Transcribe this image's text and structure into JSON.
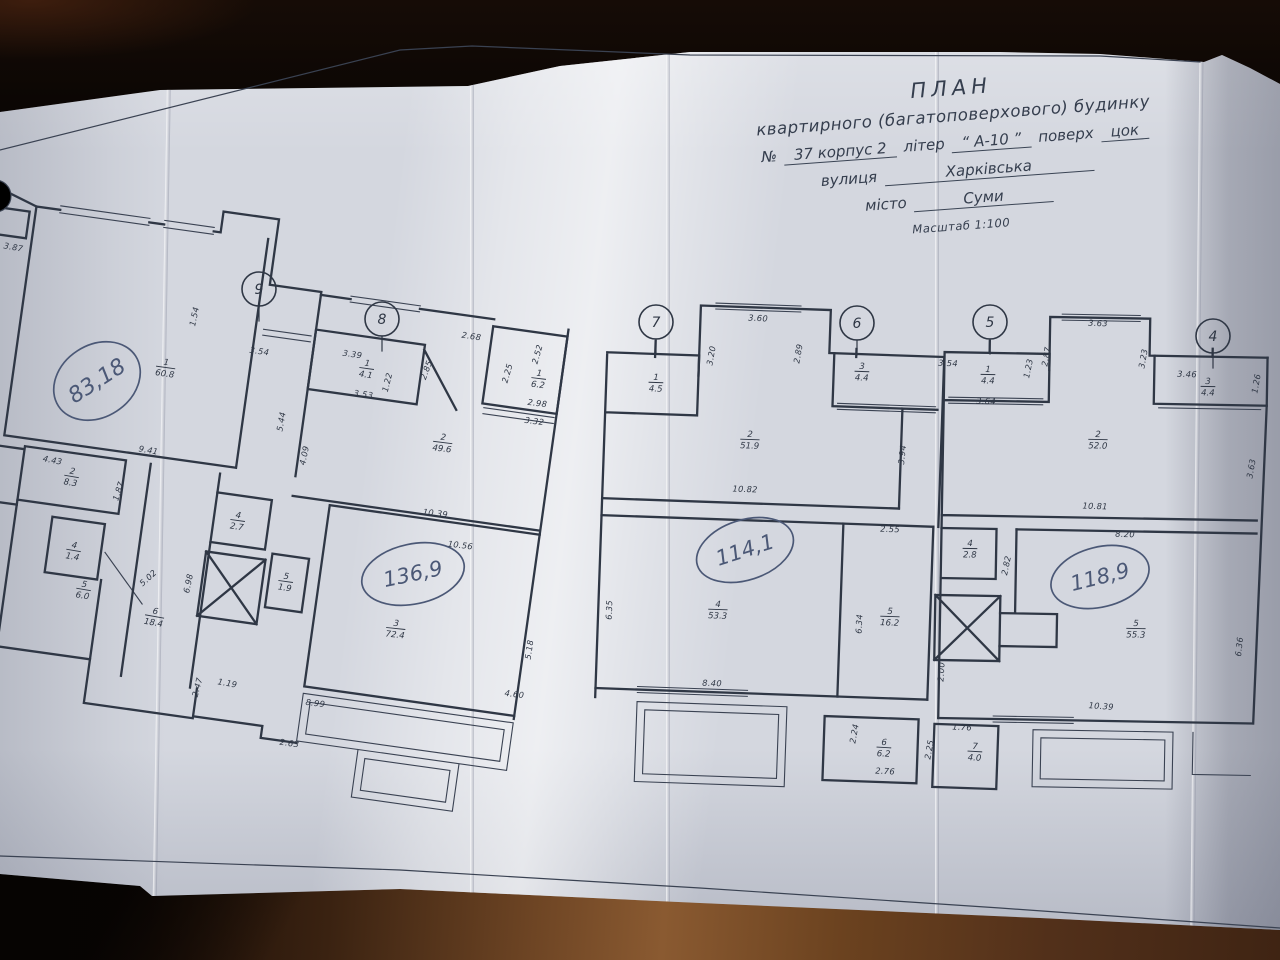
{
  "title_block": {
    "line1": "ПЛАН",
    "line2": "квартирного (багатоповерхового) будинку",
    "no_label": "№",
    "no_value": "37 корпус 2",
    "liter_label": "літер",
    "liter_value": "“ А-10 ”",
    "floor_label": "поверх",
    "floor_value": "цок",
    "street_label": "вулиця",
    "street_value": "Харківська",
    "city_label": "місто",
    "city_value": "Суми",
    "scale": "Масштаб 1:100"
  },
  "plan": {
    "ink": "#2f3745",
    "pen": "#4b5876",
    "axes": [
      {
        "label": "9",
        "x": 259,
        "y": 289
      },
      {
        "label": "8",
        "x": 382,
        "y": 319
      },
      {
        "label": "7",
        "x": 656,
        "y": 322
      },
      {
        "label": "6",
        "x": 857,
        "y": 323
      },
      {
        "label": "5",
        "x": 990,
        "y": 322
      },
      {
        "label": "4",
        "x": 1213,
        "y": 336
      }
    ],
    "handwritten": [
      {
        "text": "83,18",
        "x": 97,
        "y": 381,
        "rot": -33,
        "rx": 46,
        "ry": 36,
        "fs": 22
      },
      {
        "text": "136,9",
        "x": 413,
        "y": 574,
        "rot": -12,
        "rx": 52,
        "ry": 30,
        "fs": 21
      },
      {
        "text": "114,1",
        "x": 745,
        "y": 550,
        "rot": -18,
        "rx": 50,
        "ry": 30,
        "fs": 21
      },
      {
        "text": "118,9",
        "x": 1100,
        "y": 577,
        "rot": -14,
        "rx": 50,
        "ry": 30,
        "fs": 21
      }
    ],
    "rooms": [
      {
        "num": "1",
        "area": "60.8",
        "x": 166,
        "y": 365,
        "rot": 8
      },
      {
        "num": "2",
        "area": "8.3",
        "x": 72,
        "y": 474,
        "rot": 10
      },
      {
        "num": "4",
        "area": "1.4",
        "x": 74,
        "y": 548,
        "rot": 10
      },
      {
        "num": "5",
        "area": "6.0",
        "x": 84,
        "y": 587,
        "rot": 10
      },
      {
        "num": "6",
        "area": "18.4",
        "x": 155,
        "y": 614,
        "rot": 10
      },
      {
        "num": "4",
        "area": "2.7",
        "x": 238,
        "y": 518,
        "rot": 8
      },
      {
        "num": "5",
        "area": "1.9",
        "x": 286,
        "y": 579,
        "rot": 8
      },
      {
        "num": "3",
        "area": "72.4",
        "x": 396,
        "y": 626,
        "rot": 6
      },
      {
        "num": "1",
        "area": "4.1",
        "x": 367,
        "y": 366,
        "rot": 8
      },
      {
        "num": "2",
        "area": "49.6",
        "x": 443,
        "y": 440,
        "rot": 7
      },
      {
        "num": "1",
        "area": "6.2",
        "x": 539,
        "y": 376,
        "rot": 7
      },
      {
        "num": "1",
        "area": "4.5",
        "x": 656,
        "y": 380,
        "rot": 2
      },
      {
        "num": "2",
        "area": "51.9",
        "x": 750,
        "y": 437,
        "rot": 2
      },
      {
        "num": "3",
        "area": "4.4",
        "x": 862,
        "y": 369,
        "rot": 2
      },
      {
        "num": "4",
        "area": "53.3",
        "x": 718,
        "y": 607,
        "rot": 2
      },
      {
        "num": "5",
        "area": "16.2",
        "x": 890,
        "y": 614,
        "rot": 2
      },
      {
        "num": "6",
        "area": "6.2",
        "x": 884,
        "y": 745,
        "rot": 3
      },
      {
        "num": "7",
        "area": "4.0",
        "x": 975,
        "y": 749,
        "rot": 3
      },
      {
        "num": "1",
        "area": "4.4",
        "x": 988,
        "y": 372,
        "rot": 1
      },
      {
        "num": "2",
        "area": "52.0",
        "x": 1098,
        "y": 437,
        "rot": 1
      },
      {
        "num": "3",
        "area": "4.4",
        "x": 1208,
        "y": 384,
        "rot": 1
      },
      {
        "num": "4",
        "area": "2.8",
        "x": 970,
        "y": 546,
        "rot": 1
      },
      {
        "num": "5",
        "area": "55.3",
        "x": 1136,
        "y": 626,
        "rot": 1
      }
    ],
    "dimensions": [
      {
        "t": "3.87",
        "x": 13,
        "y": 250,
        "r": 10
      },
      {
        "t": "1.54",
        "x": 197,
        "y": 317,
        "r": -78
      },
      {
        "t": "3.54",
        "x": 259,
        "y": 354,
        "r": 8
      },
      {
        "t": "5.44",
        "x": 284,
        "y": 422,
        "r": -80
      },
      {
        "t": "4.09",
        "x": 307,
        "y": 456,
        "r": -78
      },
      {
        "t": "9.41",
        "x": 148,
        "y": 453,
        "r": 10
      },
      {
        "t": "4.43",
        "x": 52,
        "y": 463,
        "r": 11
      },
      {
        "t": "1.87",
        "x": 121,
        "y": 492,
        "r": -72
      },
      {
        "t": "3.39",
        "x": 352,
        "y": 357,
        "r": 8
      },
      {
        "t": "3.53",
        "x": 363,
        "y": 397,
        "r": 8
      },
      {
        "t": "1.22",
        "x": 390,
        "y": 383,
        "r": -76
      },
      {
        "t": "2.85",
        "x": 429,
        "y": 371,
        "r": -70
      },
      {
        "t": "2.68",
        "x": 471,
        "y": 339,
        "r": 8
      },
      {
        "t": "2.52",
        "x": 540,
        "y": 355,
        "r": -74
      },
      {
        "t": "2.25",
        "x": 510,
        "y": 374,
        "r": -74
      },
      {
        "t": "2.98",
        "x": 537,
        "y": 406,
        "r": 7
      },
      {
        "t": "3.32",
        "x": 534,
        "y": 424,
        "r": 7
      },
      {
        "t": "10.39",
        "x": 435,
        "y": 516,
        "r": 7
      },
      {
        "t": "10.56",
        "x": 460,
        "y": 548,
        "r": 7
      },
      {
        "t": "6.98",
        "x": 191,
        "y": 584,
        "r": -78
      },
      {
        "t": "5.02",
        "x": 150,
        "y": 580,
        "r": -42
      },
      {
        "t": "2.47",
        "x": 200,
        "y": 688,
        "r": -75
      },
      {
        "t": "1.19",
        "x": 227,
        "y": 686,
        "r": 10
      },
      {
        "t": "2.63",
        "x": 289,
        "y": 746,
        "r": 8
      },
      {
        "t": "8.99",
        "x": 315,
        "y": 706,
        "r": 7
      },
      {
        "t": "5.18",
        "x": 532,
        "y": 650,
        "r": -82
      },
      {
        "t": "4.60",
        "x": 514,
        "y": 697,
        "r": 7
      },
      {
        "t": "3.60",
        "x": 758,
        "y": 321,
        "r": 3
      },
      {
        "t": "3.20",
        "x": 714,
        "y": 356,
        "r": -80
      },
      {
        "t": "2.89",
        "x": 801,
        "y": 354,
        "r": -80
      },
      {
        "t": "3.94",
        "x": 905,
        "y": 455,
        "r": -84
      },
      {
        "t": "10.82",
        "x": 745,
        "y": 492,
        "r": 2
      },
      {
        "t": "2.55",
        "x": 890,
        "y": 532,
        "r": 2
      },
      {
        "t": "6.35",
        "x": 612,
        "y": 610,
        "r": -88
      },
      {
        "t": "6.34",
        "x": 862,
        "y": 624,
        "r": -87
      },
      {
        "t": "8.40",
        "x": 712,
        "y": 686,
        "r": 2
      },
      {
        "t": "2.24",
        "x": 857,
        "y": 734,
        "r": -80
      },
      {
        "t": "2.76",
        "x": 885,
        "y": 774,
        "r": 3
      },
      {
        "t": "1.76",
        "x": 962,
        "y": 730,
        "r": 3
      },
      {
        "t": "2.25",
        "x": 932,
        "y": 750,
        "r": -80
      },
      {
        "t": "3.54",
        "x": 948,
        "y": 366,
        "r": 2
      },
      {
        "t": "1.23",
        "x": 1031,
        "y": 369,
        "r": -78
      },
      {
        "t": "3.64",
        "x": 986,
        "y": 404,
        "r": 2
      },
      {
        "t": "2.87",
        "x": 1049,
        "y": 357,
        "r": -80
      },
      {
        "t": "3.63",
        "x": 1098,
        "y": 326,
        "r": 2
      },
      {
        "t": "3.23",
        "x": 1146,
        "y": 359,
        "r": -80
      },
      {
        "t": "3.46",
        "x": 1187,
        "y": 377,
        "r": 2
      },
      {
        "t": "1.26",
        "x": 1259,
        "y": 384,
        "r": -80
      },
      {
        "t": "10.81",
        "x": 1095,
        "y": 509,
        "r": 2
      },
      {
        "t": "3.63",
        "x": 1254,
        "y": 469,
        "r": -80
      },
      {
        "t": "8.20",
        "x": 1125,
        "y": 537,
        "r": 2
      },
      {
        "t": "2.82",
        "x": 1009,
        "y": 566,
        "r": -78
      },
      {
        "t": "2.00",
        "x": 944,
        "y": 672,
        "r": -86
      },
      {
        "t": "6.36",
        "x": 1242,
        "y": 647,
        "r": -84
      },
      {
        "t": "10.39",
        "x": 1101,
        "y": 709,
        "r": 4
      }
    ]
  }
}
